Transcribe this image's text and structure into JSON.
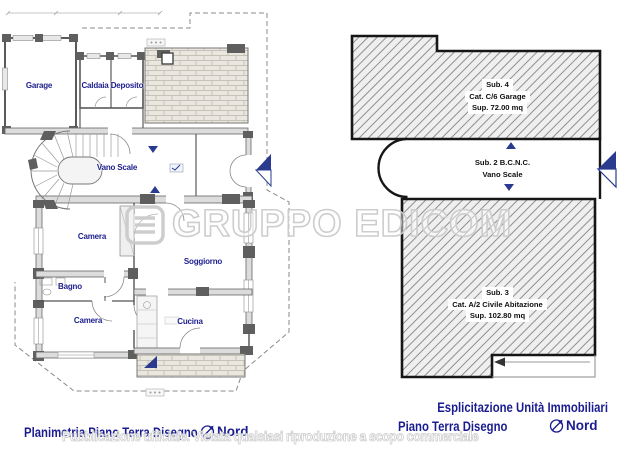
{
  "watermark": {
    "brand": "GRUPPO EDICOM",
    "notice": "Pubblicazione ufficiale. Vietata qualsiasi riproduzione a scopo commerciale"
  },
  "left_panel": {
    "rooms": {
      "garage": "Garage",
      "caldaia": "Caldaia",
      "deposito": "Deposito",
      "vano_scale": "Vano Scale",
      "camera1": "Camera",
      "soggiorno": "Soggiorno",
      "bagno": "Bagno",
      "camera2": "Camera",
      "cucina": "Cucina"
    },
    "caption": "Planimetria Piano Terra Disegno",
    "north_label": "Nord"
  },
  "right_panel": {
    "units": {
      "sub4": {
        "line1": "Sub. 4",
        "line2": "Cat. C/6 Garage",
        "line3": "Sup. 72.00 mq"
      },
      "sub2": {
        "line1": "Sub. 2 B.C.N.C.",
        "line2": "Vano Scale"
      },
      "sub3": {
        "line1": "Sub. 3",
        "line2": "Cat. A/2 Civile Abitazione",
        "line3": "Sup. 102.80 mq"
      }
    },
    "caption_line1": "Esplicitazione Unità Immobiliari",
    "caption_line2": "Piano Terra Disegno",
    "north_label": "Nord"
  },
  "colors": {
    "label_navy": "#1c1f8e",
    "caption_navy": "#1a1d8f",
    "hatch_gray": "#8f8f8f",
    "wall_gray": "#dcdcdc"
  }
}
